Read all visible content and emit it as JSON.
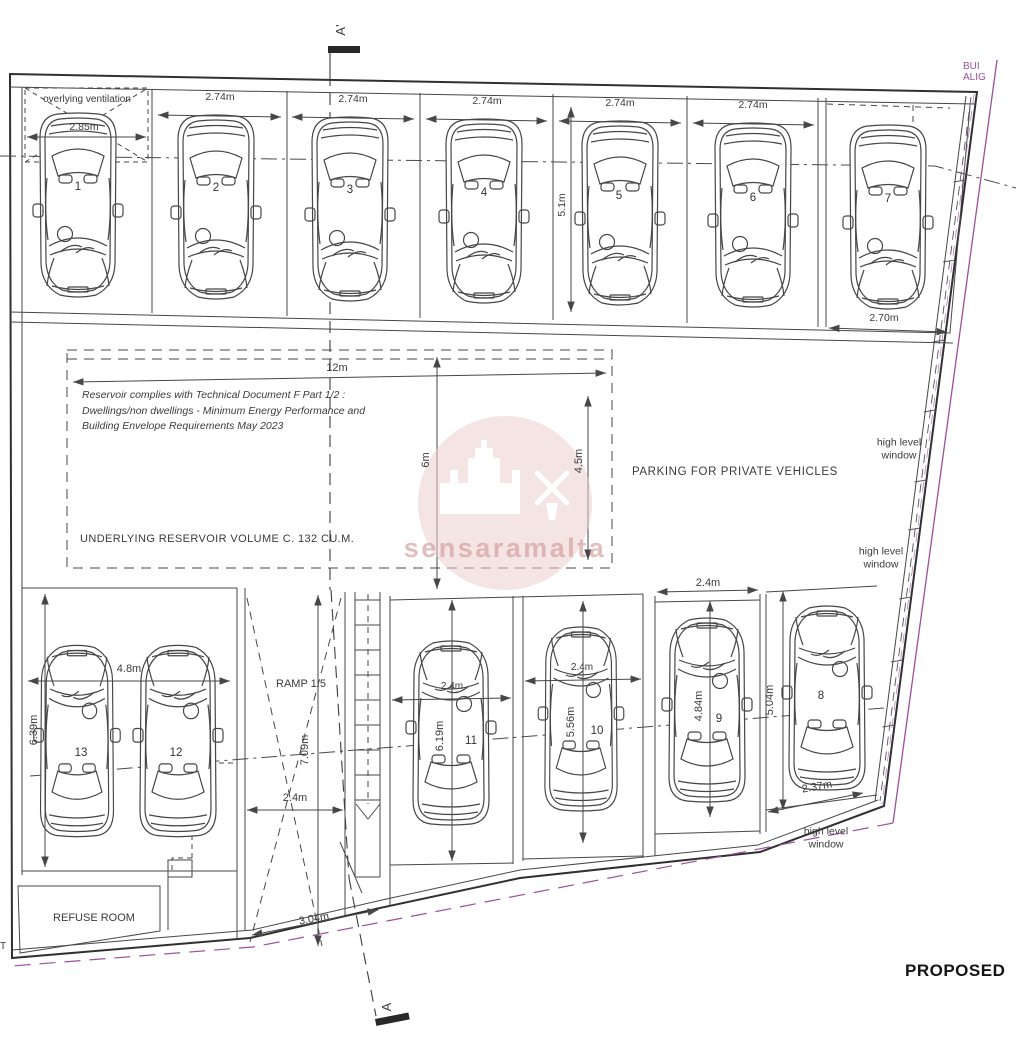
{
  "markers": {
    "section_top": "A'",
    "section_bottom": "A",
    "proposed": "PROPOSED",
    "watermark": "sensaramalta",
    "boundary_fragment": "BUI\nALIG",
    "street_fragment": "T"
  },
  "notes": {
    "overlying_ventilation": "overlying ventilation",
    "reservoir_note": "Reservoir complies with Technical Document F Part 1/2 :\nDwellings/non dwellings - Minimum Energy Performance and\nBuilding Envelope Requirements May 2023",
    "reservoir_volume": "UNDERLYING RESERVOIR VOLUME C. 132 CU.M.",
    "parking_area": "PARKING FOR PRIVATE VEHICLES",
    "ramp": "RAMP 1:5",
    "refuse_room": "REFUSE ROOM",
    "high_level_window": "high level\nwindow"
  },
  "stalls": [
    {
      "number": "1",
      "width": "2.85m"
    },
    {
      "number": "2",
      "width": "2.74m"
    },
    {
      "number": "3",
      "width": "2.74m"
    },
    {
      "number": "4",
      "width": "2.74m"
    },
    {
      "number": "5",
      "width": "2.74m",
      "depth": "5.1m"
    },
    {
      "number": "6",
      "width": "2.74m"
    },
    {
      "number": "7",
      "width": "2.70m"
    },
    {
      "number": "8",
      "width": "2.37m",
      "depth": "5.04m"
    },
    {
      "number": "9",
      "width": "2.4m",
      "depth": "4.84m"
    },
    {
      "number": "10",
      "width": "2.4m",
      "depth": "5.56m"
    },
    {
      "number": "11",
      "width": "2.4m",
      "depth": "6.19m"
    },
    {
      "number": "12"
    },
    {
      "number": "13",
      "depth": "6.39m"
    }
  ],
  "dimensions": {
    "reservoir_width": "12m",
    "reservoir_depth": "6m",
    "reservoir_clear_depth": "4.5m",
    "double_stall_width": "4.8m",
    "ramp_length": "7.09m",
    "ramp_width": "2.4m",
    "entrance_width": "3.04m"
  },
  "colors": {
    "line": "#474747",
    "boundary_purple": "#9e4f9e",
    "watermark_pink": "#eccfcf",
    "watermark_text": "#d9a9a9"
  }
}
